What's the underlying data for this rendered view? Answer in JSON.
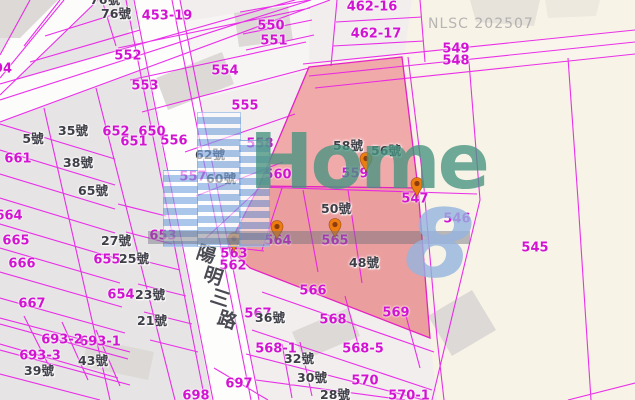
{
  "map": {
    "agency_watermark": "NLSC 202507",
    "brand_watermark": "Home",
    "brand_numeral": "8",
    "road": {
      "name": "陽明三路",
      "chars": [
        "陽",
        "明",
        "三",
        "路"
      ]
    },
    "colors": {
      "parcel_line": "#e81ae8",
      "parcel_label": "#d214d2",
      "address_label": "#3e3e47",
      "highlight_pink_upper": "#f0aaaa",
      "highlight_pink_lower": "#eb9e9e",
      "base_beige": "#f8f3e7",
      "base_gray": "#e7e4e5",
      "pin_body": "#ed7d10",
      "pin_dot": "#8d3c0e",
      "watermark_teal": "#4694800",
      "watermark_blue": "#94b4de"
    },
    "parcel_labels": [
      {
        "t": "453-19",
        "x": 167,
        "y": 16
      },
      {
        "t": "550",
        "x": 271,
        "y": 26
      },
      {
        "t": "551",
        "x": 274,
        "y": 41
      },
      {
        "t": "552",
        "x": 128,
        "y": 56
      },
      {
        "t": "553",
        "x": 145,
        "y": 86
      },
      {
        "t": "554",
        "x": 225,
        "y": 71
      },
      {
        "t": "555",
        "x": 245,
        "y": 106
      },
      {
        "t": "556",
        "x": 174,
        "y": 141
      },
      {
        "t": "557",
        "x": 193,
        "y": 177
      },
      {
        "t": "558",
        "x": 260,
        "y": 144
      },
      {
        "t": "559",
        "x": 355,
        "y": 174
      },
      {
        "t": "560",
        "x": 278,
        "y": 175
      },
      {
        "t": "562",
        "x": 233,
        "y": 266
      },
      {
        "t": "563",
        "x": 234,
        "y": 254
      },
      {
        "t": "564",
        "x": 278,
        "y": 241
      },
      {
        "t": "565",
        "x": 335,
        "y": 241
      },
      {
        "t": "566",
        "x": 313,
        "y": 291
      },
      {
        "t": "567",
        "x": 258,
        "y": 314
      },
      {
        "t": "568",
        "x": 333,
        "y": 320
      },
      {
        "t": "569",
        "x": 396,
        "y": 313
      },
      {
        "t": "568-1",
        "x": 276,
        "y": 349
      },
      {
        "t": "568-5",
        "x": 363,
        "y": 349
      },
      {
        "t": "570",
        "x": 365,
        "y": 381
      },
      {
        "t": "570-1",
        "x": 409,
        "y": 396
      },
      {
        "t": "545",
        "x": 535,
        "y": 248
      },
      {
        "t": "546",
        "x": 457,
        "y": 219
      },
      {
        "t": "547",
        "x": 415,
        "y": 199
      },
      {
        "t": "548",
        "x": 456,
        "y": 61
      },
      {
        "t": "549",
        "x": 456,
        "y": 49
      },
      {
        "t": "650",
        "x": 152,
        "y": 132
      },
      {
        "t": "651",
        "x": 134,
        "y": 142
      },
      {
        "t": "652",
        "x": 116,
        "y": 132
      },
      {
        "t": "653",
        "x": 163,
        "y": 236
      },
      {
        "t": "654",
        "x": 121,
        "y": 295
      },
      {
        "t": "655",
        "x": 107,
        "y": 260
      },
      {
        "t": "661",
        "x": 18,
        "y": 159
      },
      {
        "t": "664",
        "x": 9,
        "y": 216
      },
      {
        "t": "665",
        "x": 16,
        "y": 241
      },
      {
        "t": "666",
        "x": 22,
        "y": 264
      },
      {
        "t": "667",
        "x": 32,
        "y": 304
      },
      {
        "t": "693-1",
        "x": 100,
        "y": 342
      },
      {
        "t": "693-2",
        "x": 62,
        "y": 340
      },
      {
        "t": "693-3",
        "x": 40,
        "y": 356
      },
      {
        "t": "697",
        "x": 239,
        "y": 384
      },
      {
        "t": "698",
        "x": 196,
        "y": 396
      },
      {
        "t": "462-16",
        "x": 372,
        "y": 7
      },
      {
        "t": "462-17",
        "x": 376,
        "y": 34
      },
      {
        "t": "94",
        "x": 3,
        "y": 69
      }
    ],
    "address_labels": [
      {
        "t": "76號",
        "x": 105,
        "y": 0
      },
      {
        "t": "76號",
        "x": 116,
        "y": 14
      },
      {
        "t": "5號",
        "x": 33,
        "y": 139
      },
      {
        "t": "35號",
        "x": 73,
        "y": 131
      },
      {
        "t": "38號",
        "x": 78,
        "y": 163
      },
      {
        "t": "65號",
        "x": 93,
        "y": 191
      },
      {
        "t": "27號",
        "x": 116,
        "y": 241
      },
      {
        "t": "25號",
        "x": 134,
        "y": 259
      },
      {
        "t": "23號",
        "x": 150,
        "y": 295
      },
      {
        "t": "21號",
        "x": 152,
        "y": 321
      },
      {
        "t": "43號",
        "x": 93,
        "y": 361
      },
      {
        "t": "39號",
        "x": 39,
        "y": 371
      },
      {
        "t": "62號",
        "x": 210,
        "y": 155
      },
      {
        "t": "60號",
        "x": 221,
        "y": 179
      },
      {
        "t": "58號",
        "x": 348,
        "y": 146
      },
      {
        "t": "56號",
        "x": 386,
        "y": 151
      },
      {
        "t": "50號",
        "x": 336,
        "y": 209
      },
      {
        "t": "48號",
        "x": 364,
        "y": 263
      },
      {
        "t": "36號",
        "x": 270,
        "y": 318
      },
      {
        "t": "32號",
        "x": 299,
        "y": 359
      },
      {
        "t": "30號",
        "x": 312,
        "y": 378
      },
      {
        "t": "28號",
        "x": 335,
        "y": 395
      }
    ],
    "pins": [
      {
        "x": 366,
        "y": 172
      },
      {
        "x": 417,
        "y": 197
      },
      {
        "x": 277,
        "y": 240
      },
      {
        "x": 335,
        "y": 238
      },
      {
        "x": 234,
        "y": 252
      }
    ],
    "road_char_anchors": [
      {
        "x": 206,
        "y": 255
      },
      {
        "x": 213,
        "y": 277
      },
      {
        "x": 220,
        "y": 299
      },
      {
        "x": 227,
        "y": 321
      }
    ]
  }
}
